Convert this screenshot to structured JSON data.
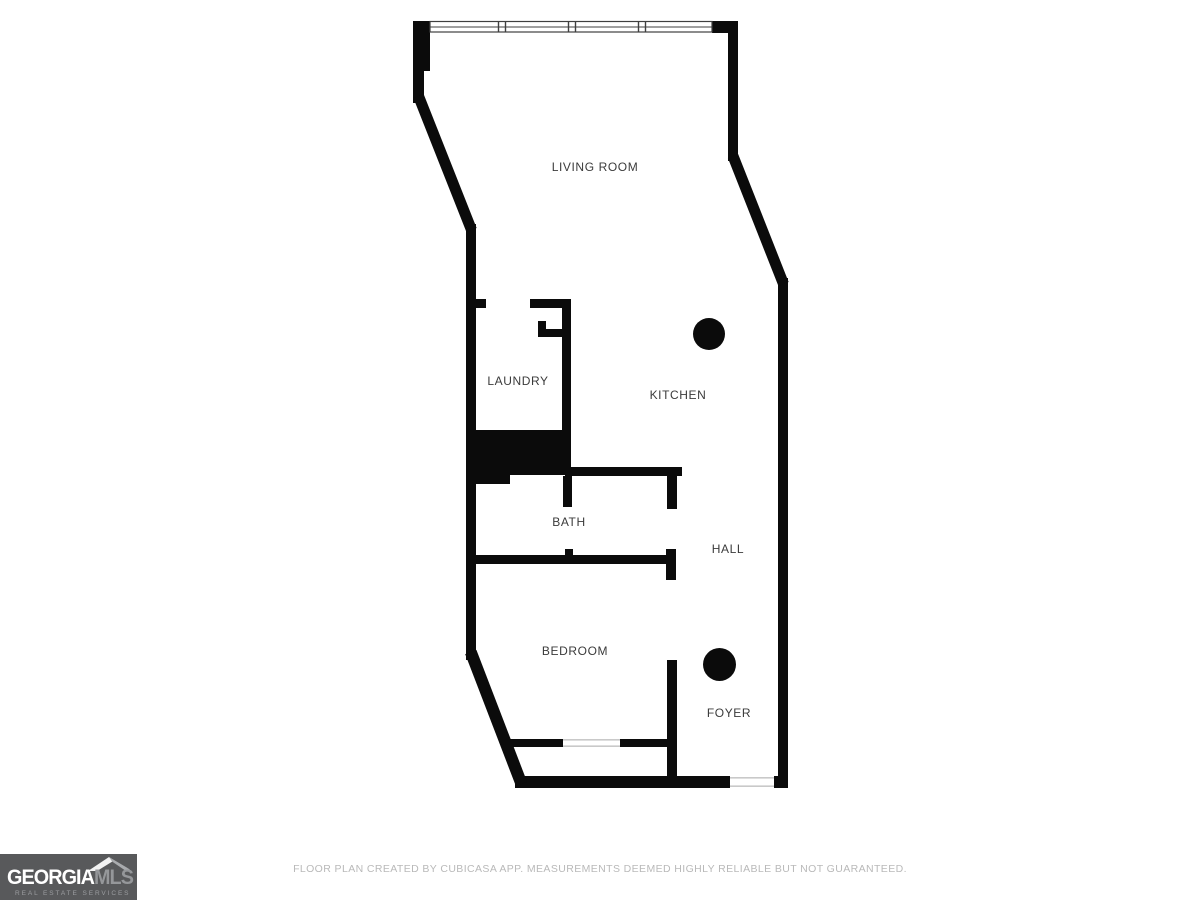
{
  "floor_plan": {
    "rooms": [
      {
        "id": "living-room",
        "label": "LIVING ROOM"
      },
      {
        "id": "laundry",
        "label": "LAUNDRY"
      },
      {
        "id": "kitchen",
        "label": "KITCHEN"
      },
      {
        "id": "bath",
        "label": "BATH"
      },
      {
        "id": "hall",
        "label": "HALL"
      },
      {
        "id": "bedroom",
        "label": "BEDROOM"
      },
      {
        "id": "foyer",
        "label": "FOYER"
      }
    ],
    "fixtures": [
      {
        "name": "column-kitchen"
      },
      {
        "name": "column-foyer"
      }
    ],
    "colors": {
      "wall": "#0b0b0b",
      "room_label": "#3b3b3b",
      "window_line": "#3f3f3f",
      "threshold_line": "#c9c9c9"
    }
  },
  "footer": {
    "disclaimer": "FLOOR PLAN CREATED BY CUBICASA APP. MEASUREMENTS DEEMED HIGHLY RELIABLE BUT NOT GUARANTEED."
  },
  "logo": {
    "brand_primary": "GEORGIA",
    "brand_secondary": "MLS",
    "tagline": "REAL ESTATE SERVICES",
    "colors": {
      "background": "#58595b",
      "primary_text": "#ffffff",
      "secondary_text": "#95979a",
      "tagline_text": "#9b9da0"
    }
  }
}
